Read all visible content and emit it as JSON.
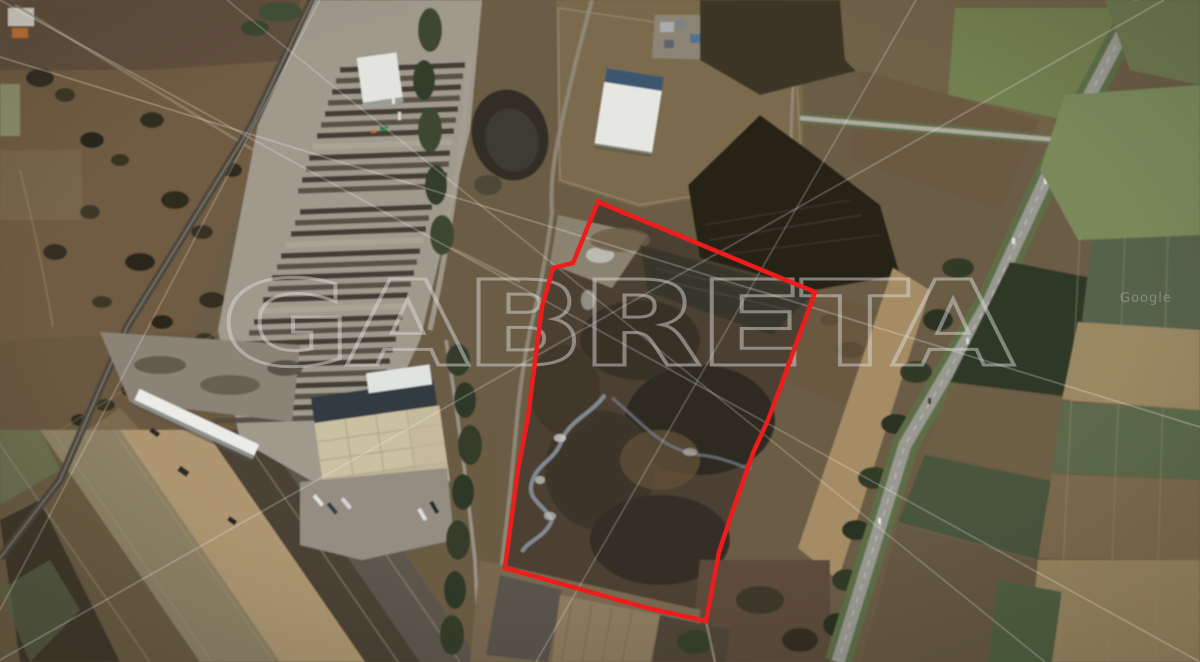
{
  "image": {
    "kind": "satellite-aerial-photo",
    "watermark_text": "GABRETA",
    "imagery_credit": "Google"
  },
  "annotation": {
    "parcel_outline_color": "#ee1c1a",
    "parcel_outline_points": "598,202 815,292 783,380 768,420 753,453 733,510 719,552 706,621 647,608 505,568 518,470 528,417 542,307 553,268 573,263"
  },
  "palette": {
    "accent_red": "#ee1c1a",
    "watermark_grey": "#dedede",
    "terrain_base": "#6a5a44",
    "highway_grey": "#9b9b94",
    "field_green": "#7b8b5a",
    "warehouse_roof": "#cfc4a6"
  }
}
